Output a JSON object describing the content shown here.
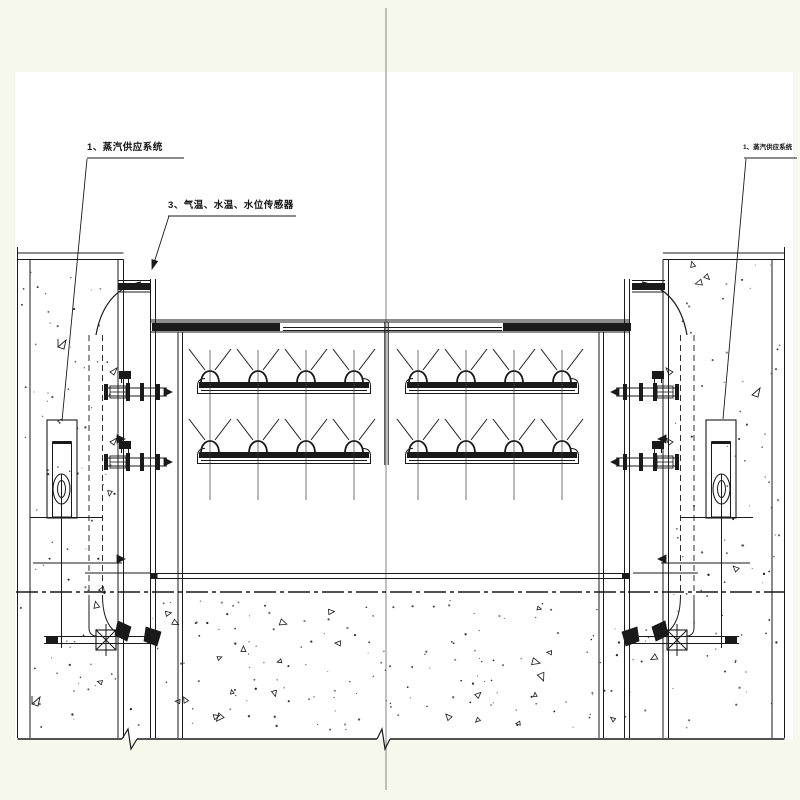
{
  "labels": {
    "steam_supply_left": "1、蒸汽供应系统",
    "sensors": "3、气温、水温、水位传感器",
    "steam_supply_right": "1、蒸汽供应系统"
  },
  "colors": {
    "paper": "#f6f8ee",
    "drawing_background": "#ffffff",
    "line": "#1a1a1a",
    "centerline": "#666666"
  }
}
